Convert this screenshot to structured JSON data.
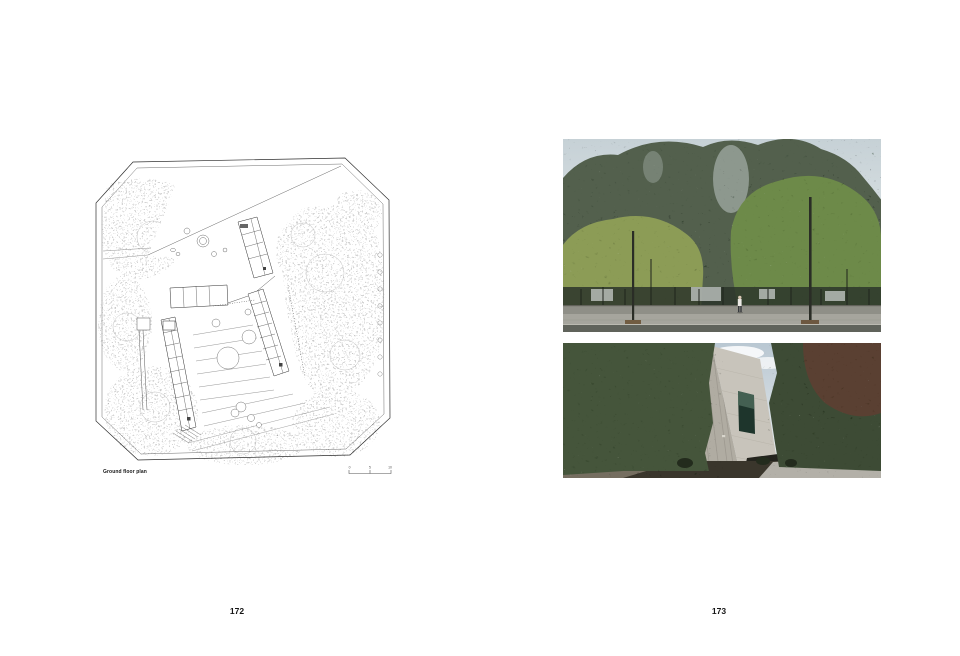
{
  "left_page": {
    "page_number": "172",
    "plan_caption": "Ground floor plan",
    "scale_labels": [
      "0",
      "5",
      "10"
    ]
  },
  "right_page": {
    "page_number": "173"
  },
  "colors": {
    "paper": "#ffffff",
    "plan_ink": "#2f2f2f",
    "plan_stipple_light": "#8f8f8f",
    "plan_stipple_dark": "#2e2e2e",
    "sky_top": "#c6d1d6",
    "sky_bottom": "#eef1f0",
    "poplar_green": "#53604d",
    "left_tree_green": "#8c9c57",
    "right_tree_green": "#6d8a48",
    "understory_dark": "#2c352a",
    "wall_gray": "#8f8f87",
    "sidewalk_gray": "#a6a59d",
    "asphalt_gray": "#60635b",
    "dense_tree_left": "#44543b",
    "dense_tree_right": "#3c4c36",
    "pod_tree_brown": "#5c4033",
    "concrete_light": "#c8c4bb",
    "concrete_shade": "#b0aca2",
    "window_green": "#1e352c",
    "pavement_light": "#b3b0a8",
    "path_dark": "#3a362c"
  }
}
